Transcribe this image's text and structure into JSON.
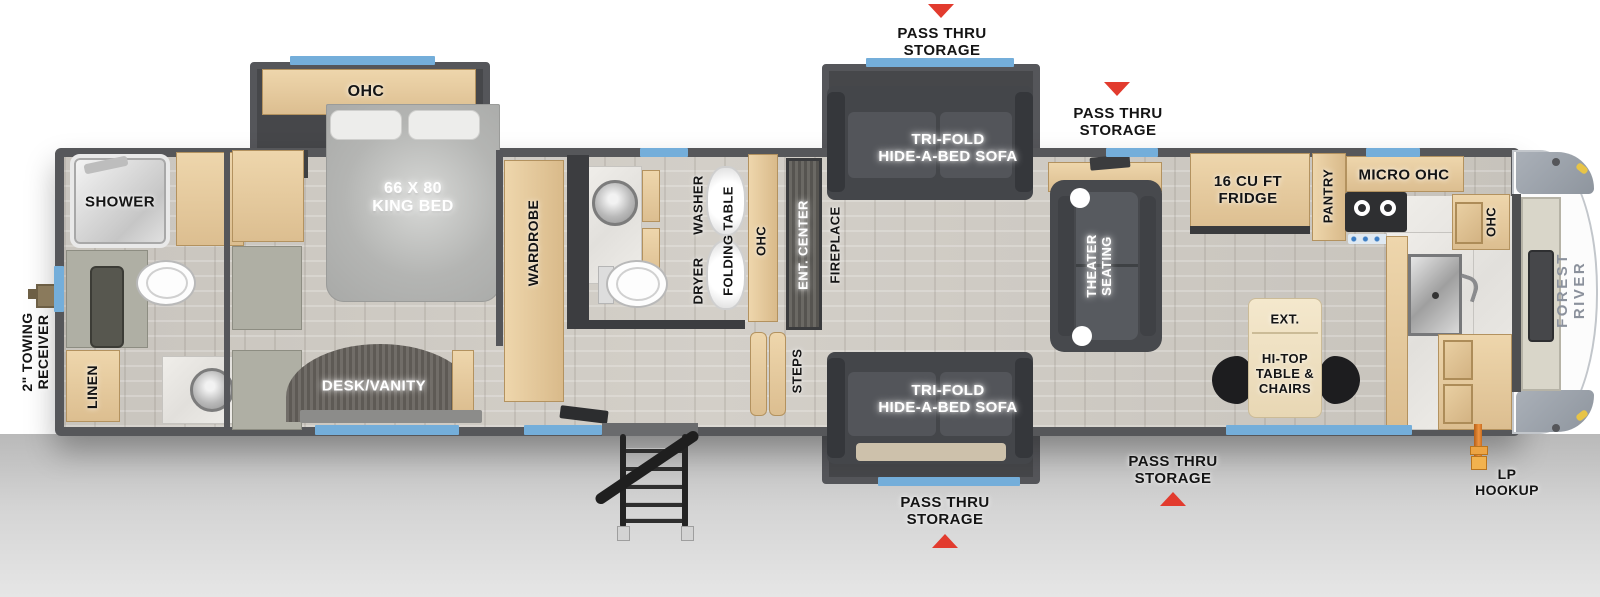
{
  "colors": {
    "wall": "#56575a",
    "window": "#74aeda",
    "arrow_red": "#e23b2e",
    "cabinet_wood": "#e4c99e",
    "floor_wood": "#ccc8c1",
    "sofa_charcoal": "#4a4c50",
    "brand_text": "#8b919c"
  },
  "exterior": {
    "towing_receiver": "2\" TOWING\nRECEIVER",
    "lp_hookup": "LP\nHOOKUP",
    "brand": "FOREST RIVER",
    "pass_thru_labels": [
      "PASS THRU\nSTORAGE",
      "PASS THRU\nSTORAGE",
      "PASS THRU\nSTORAGE",
      "PASS THRU\nSTORAGE"
    ]
  },
  "front_bath": {
    "shower": "SHOWER",
    "linen": "LINEN"
  },
  "bedroom": {
    "ohc": "OHC",
    "bed": "66 X 80\nKING BED",
    "desk_vanity": "DESK/VANITY"
  },
  "mid_bath": {
    "wardrobe": "WARDROBE",
    "washer": "WASHER",
    "dryer": "DRYER",
    "folding_table": "FOLDING TABLE",
    "ohc": "OHC"
  },
  "living": {
    "ent_center": "ENT. CENTER",
    "fireplace": "FIREPLACE",
    "steps": "STEPS",
    "sofa_top": "TRI-FOLD\nHIDE-A-BED SOFA",
    "sofa_bottom": "TRI-FOLD\nHIDE-A-BED SOFA",
    "theater": "THEATER\nSEATING"
  },
  "kitchen": {
    "fridge": "16 CU FT\nFRIDGE",
    "pantry": "PANTRY",
    "micro_ohc": "MICRO  OHC",
    "ohc": "OHC",
    "ext": "EXT.",
    "hitop": "HI-TOP\nTABLE &\nCHAIRS"
  }
}
